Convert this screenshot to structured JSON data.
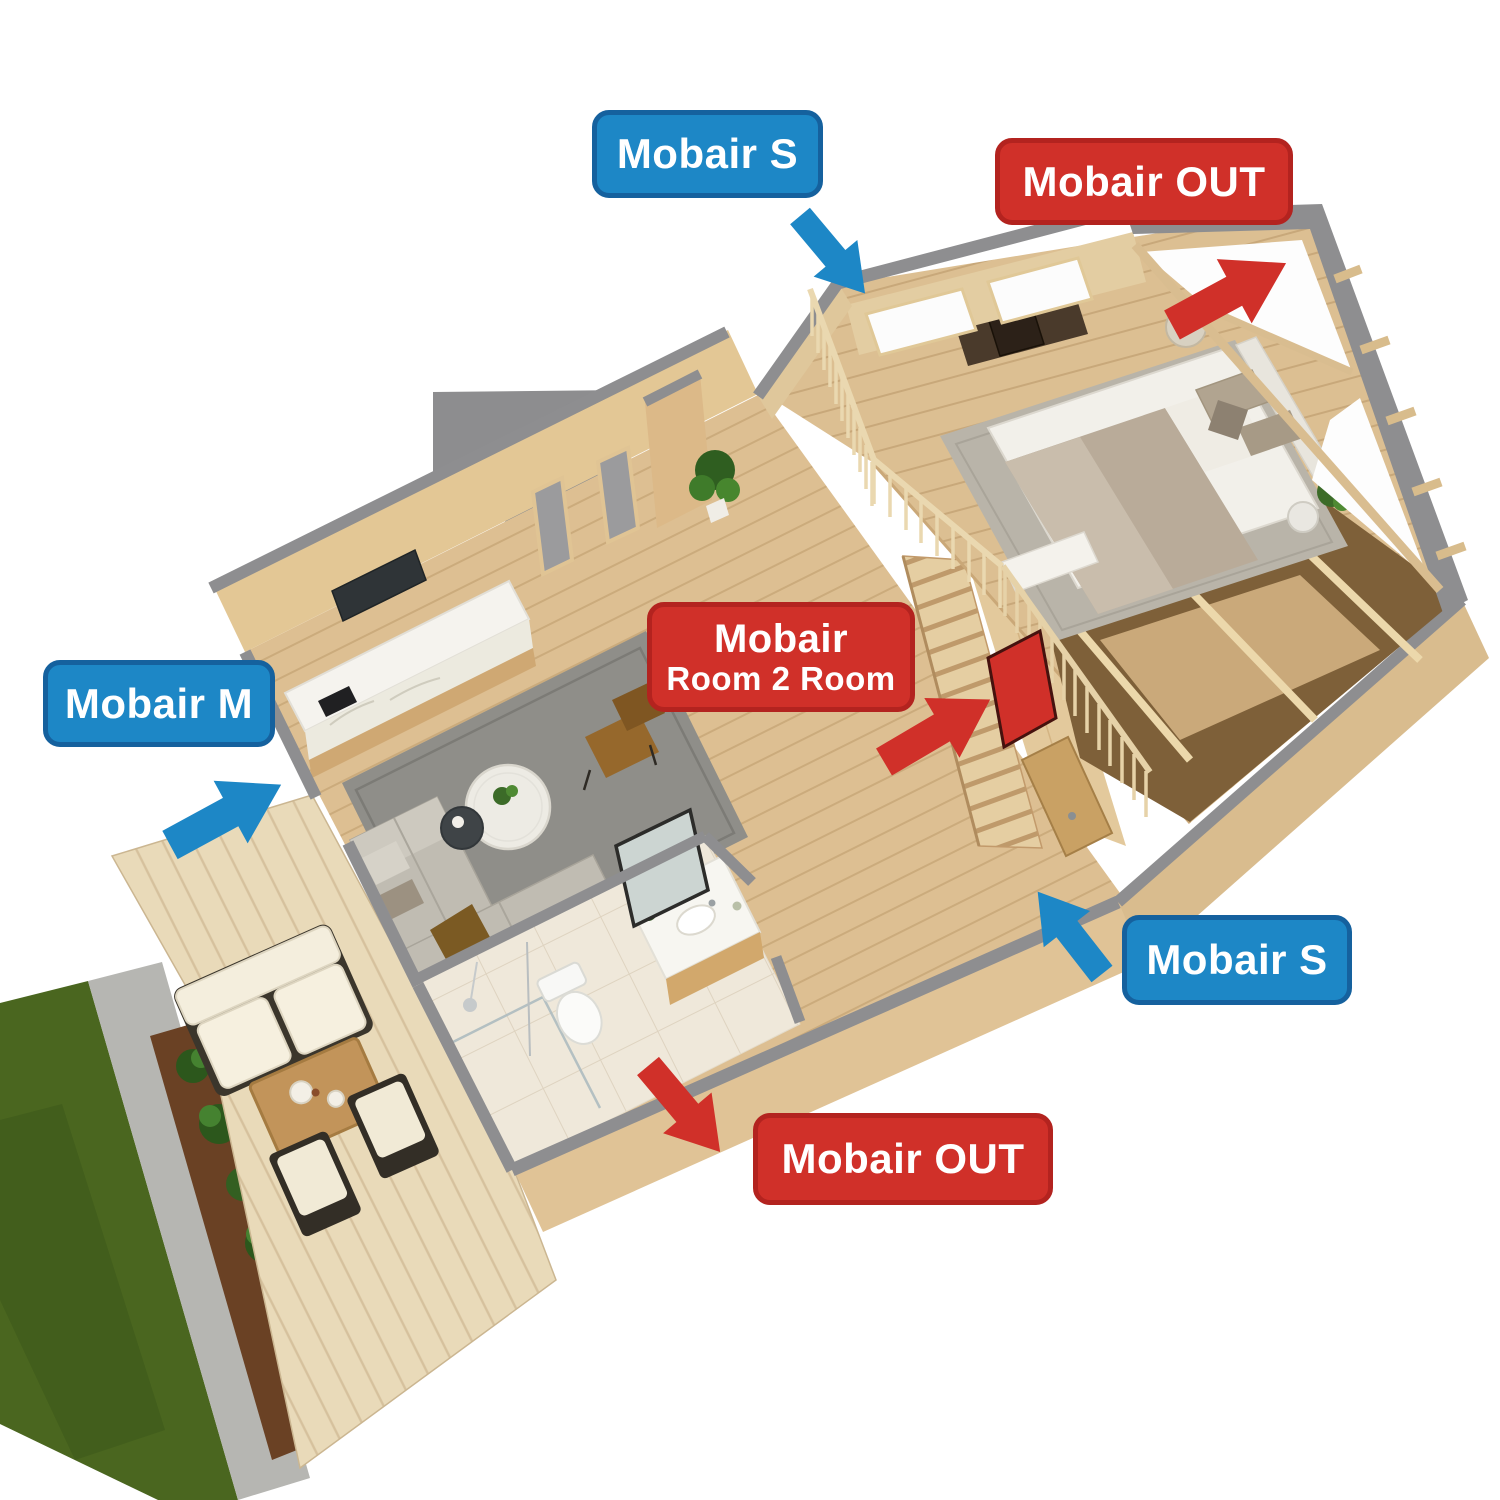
{
  "colors": {
    "supply_blue": "#1d87c6",
    "supply_blue_border": "#15619e",
    "exhaust_red": "#d03029",
    "exhaust_red_border": "#b3231f",
    "label_text": "#ffffff"
  },
  "labels": {
    "supply_top": {
      "text": "Mobair S",
      "type": "supply-air-unit"
    },
    "exhaust_top": {
      "text": "Mobair OUT",
      "type": "exhaust-air-unit"
    },
    "room2room": {
      "line1": "Mobair",
      "line2": "Room 2 Room",
      "type": "room-to-room-transfer-unit"
    },
    "supply_left": {
      "text": "Mobair M",
      "type": "supply-air-unit"
    },
    "supply_right": {
      "text": "Mobair S",
      "type": "supply-air-unit"
    },
    "exhaust_bottom": {
      "text": "Mobair OUT",
      "type": "exhaust-air-unit"
    }
  },
  "icons": {
    "arrows": [
      {
        "name": "supply-arrow-top",
        "color": "#1d87c6",
        "direction": "down-right"
      },
      {
        "name": "exhaust-arrow-top",
        "color": "#d03029",
        "direction": "up-right"
      },
      {
        "name": "exhaust-arrow-room2room",
        "color": "#d03029",
        "direction": "up-right"
      },
      {
        "name": "supply-arrow-left",
        "color": "#1d87c6",
        "direction": "up-right"
      },
      {
        "name": "supply-arrow-right",
        "color": "#1d87c6",
        "direction": "up-left"
      },
      {
        "name": "exhaust-arrow-bottom",
        "color": "#d03029",
        "direction": "down-right"
      }
    ],
    "room2room_device": {
      "name": "room2room-vent-unit-icon",
      "color": "#d03029"
    }
  }
}
